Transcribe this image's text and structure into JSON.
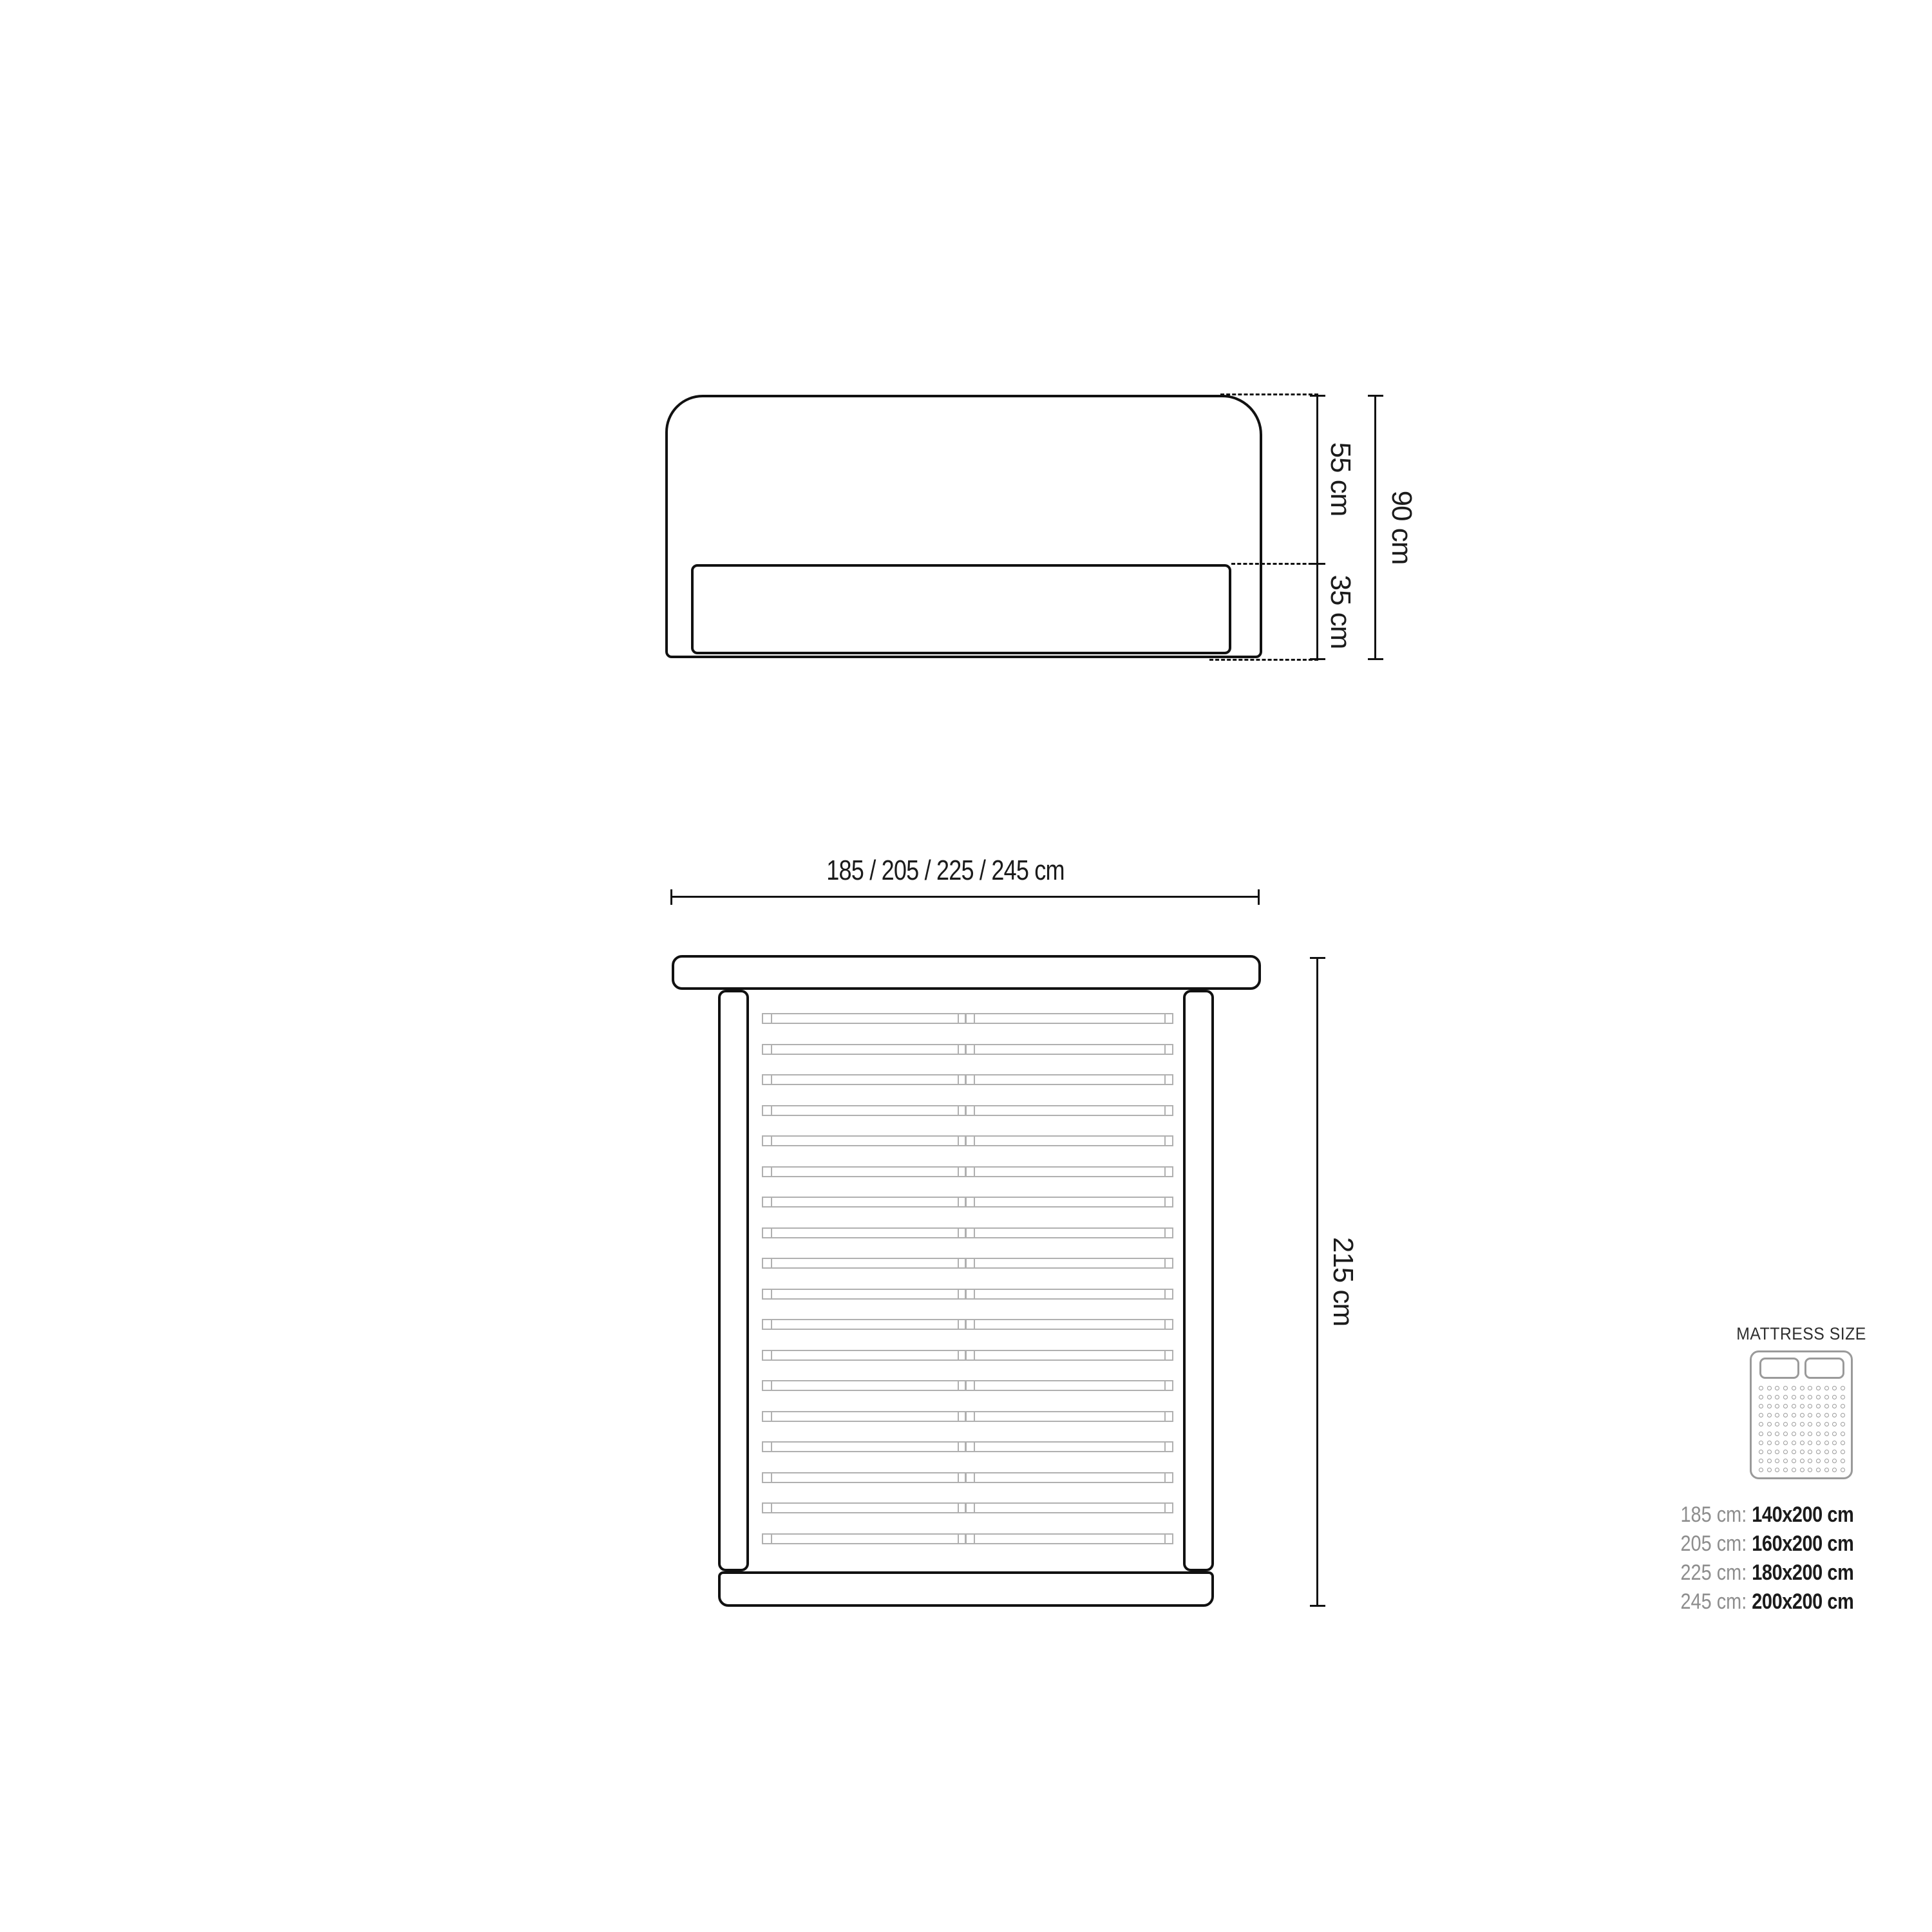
{
  "side_view": {
    "labels": {
      "upper": "55 cm",
      "lower": "35 cm",
      "total": "90 cm"
    }
  },
  "top_view": {
    "width_label": "185 / 205 / 225 / 245 cm",
    "length_label": "215 cm",
    "slat_count": 18
  },
  "legend": {
    "title": "MATTRESS SIZE",
    "icon": "mattress-top-view-icon",
    "dots": {
      "cols": 11,
      "rows": 10
    },
    "rows": [
      {
        "size": "185 cm: ",
        "mattress": "140x200 cm"
      },
      {
        "size": "205 cm: ",
        "mattress": "160x200 cm"
      },
      {
        "size": "225 cm: ",
        "mattress": "180x200 cm"
      },
      {
        "size": "245 cm: ",
        "mattress": "200x200 cm"
      }
    ]
  },
  "colors": {
    "line": "#111111",
    "slat_gray": "#b0b0b0",
    "icon_gray": "#9a9a9a",
    "text_gray": "#8e8e8e",
    "text_dark": "#1b1b1b"
  }
}
